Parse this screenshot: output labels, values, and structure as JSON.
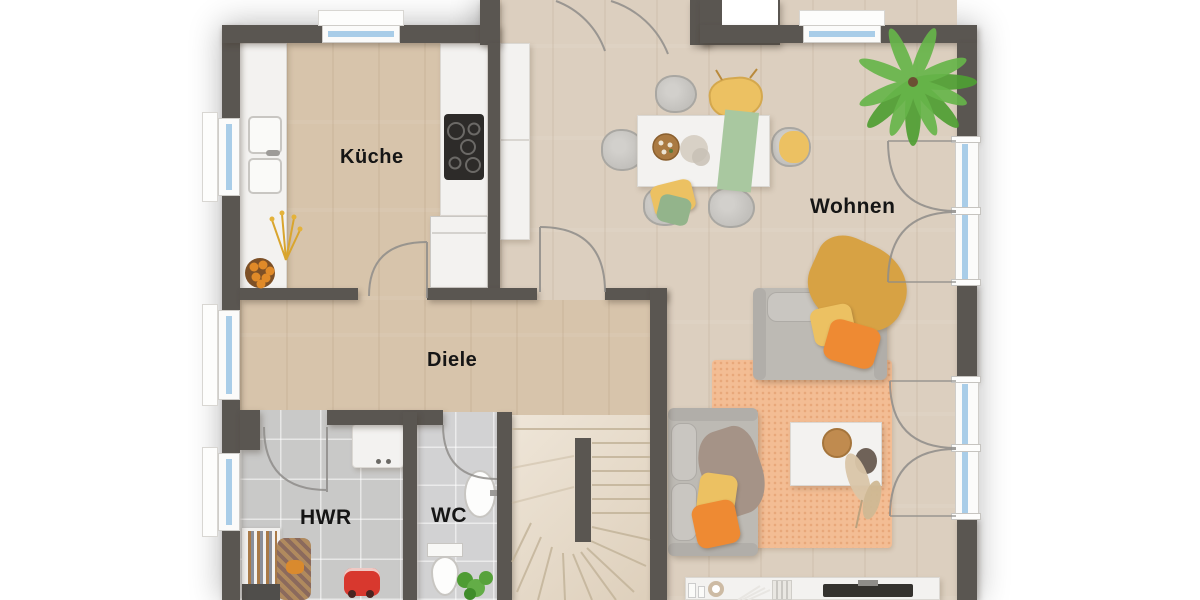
{
  "rooms": {
    "kueche": {
      "label": "Küche"
    },
    "wohnen": {
      "label": "Wohnen"
    },
    "diele": {
      "label": "Diele"
    },
    "hwr": {
      "label": "HWR"
    },
    "wc": {
      "label": "WC"
    }
  },
  "colors": {
    "wall": "#5a5651",
    "floor-wood": "#d7c4ab",
    "floor-wood-light": "#dccfbf",
    "floor-stairs": "#e9ddcb",
    "floor-tile": "#c9c9c8",
    "floor-tile-wc": "#d2d2d3",
    "window-glass": "#a9cde8",
    "furniture-white": "#f3f2f0",
    "sofa-gray": "#bdbab4",
    "accent-yellow": "#ecc162",
    "accent-orange": "#ee8a33",
    "accent-green": "#a9c8a0",
    "rug-orange": "#f3bd94",
    "blanket-mustard": "#d7a244",
    "plant-green": "#55a33a",
    "arc-gray": "#8f8d8a",
    "label-color": "#151515"
  }
}
